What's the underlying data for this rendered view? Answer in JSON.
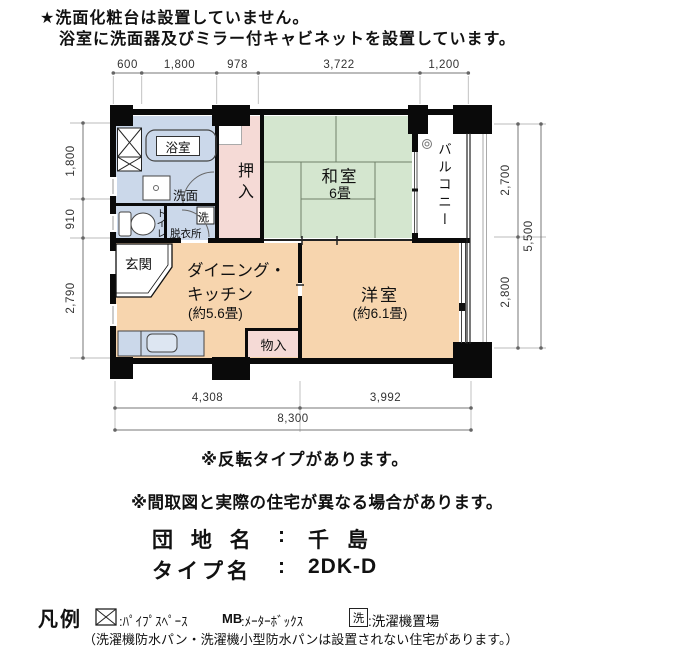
{
  "page": {
    "note1": "★洗面化粧台は設置していません。",
    "note2": "浴室に洗面器及びミラー付キャビネットを設置しています。",
    "reversal_note": "※反転タイプがあります。",
    "disclaimer": "※間取図と実際の住宅が異なる場合があります。"
  },
  "property": {
    "danchi_label": "団 地 名",
    "danchi_colon": ":",
    "danchi_value": "千 島",
    "type_label": "タイプ名",
    "type_colon": ":",
    "type_value": "2DK-D"
  },
  "legend": {
    "title": "凡例",
    "ps_text": ":ﾊﾟｲﾌﾟｽﾍﾟｰｽ",
    "mb_symbol": "MB",
    "mb_text": ":ﾒｰﾀｰﾎﾞｯｸｽ",
    "laundry_symbol": "洗",
    "laundry_text": ":洗濯機置場",
    "note": "（洗濯機防水パン・洗濯機小型防水パンは設置されない住宅があります。）"
  },
  "plan": {
    "rooms": {
      "bath": "浴室",
      "washbasin": "洗面",
      "toilet": "トイレ",
      "dressing": "脱衣所",
      "laundry": "洗",
      "closet": "押入",
      "washitsu": "和室",
      "washitsu_size": "6畳",
      "balcony": "バルコニー",
      "genkan": "玄関",
      "dk_line1": "ダイニング・",
      "dk_line2": "キッチン",
      "dk_size": "(約5.6畳)",
      "storage": "物入",
      "yoshitsu": "洋室",
      "yoshitsu_size": "(約6.1畳)"
    },
    "dims": {
      "top": [
        "600",
        "1,800",
        "978",
        "3,722",
        "1,200"
      ],
      "left": [
        "1,800",
        "910",
        "2,790"
      ],
      "right_inner": [
        "2,700",
        "2,800"
      ],
      "right_total": "5,500",
      "bottom_inner": [
        "4,308",
        "3,992"
      ],
      "bottom_total": "8,300"
    }
  },
  "colors": {
    "wet_area_blue": "#cbd8ea",
    "tatami_green": "#d4e6cf",
    "closet_pink": "#f5dad6",
    "room_orange": "#f7d5ae"
  }
}
